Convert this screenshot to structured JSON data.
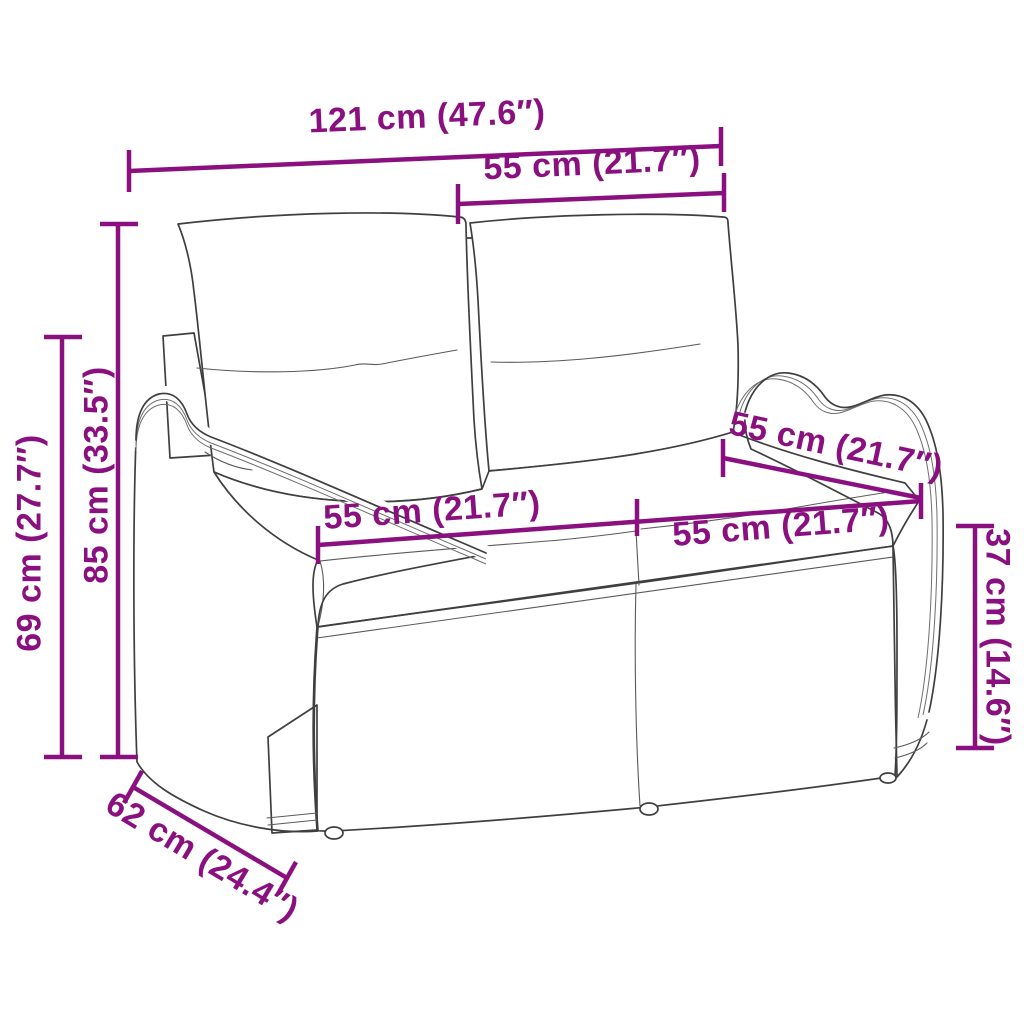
{
  "style": {
    "dimension_color": "#8a1080",
    "line_art_color": "#3f3f3f",
    "background": "#ffffff"
  },
  "illustration": {
    "subject": "poly-rattan 2-seater garden bench with back and seat cushions",
    "rendering": "black line-art drawing with woven wicker texture, white cushions"
  },
  "labels": [
    {
      "id": "overall-width",
      "text": "121 cm (47.6″)"
    },
    {
      "id": "back-cushion-width",
      "text": "55 cm (21.7″)"
    },
    {
      "id": "overall-height",
      "text": "85 cm (33.5″)"
    },
    {
      "id": "arm-height",
      "text": "69 cm (27.7″)"
    },
    {
      "id": "base-depth",
      "text": "62 cm (24.4″)"
    },
    {
      "id": "seat-width-left",
      "text": "55 cm (21.7″)"
    },
    {
      "id": "seat-width-right",
      "text": "55 cm (21.7″)"
    },
    {
      "id": "seat-depth",
      "text": "55 cm (21.7″)"
    },
    {
      "id": "seat-height",
      "text": "37 cm (14.6″)"
    }
  ]
}
